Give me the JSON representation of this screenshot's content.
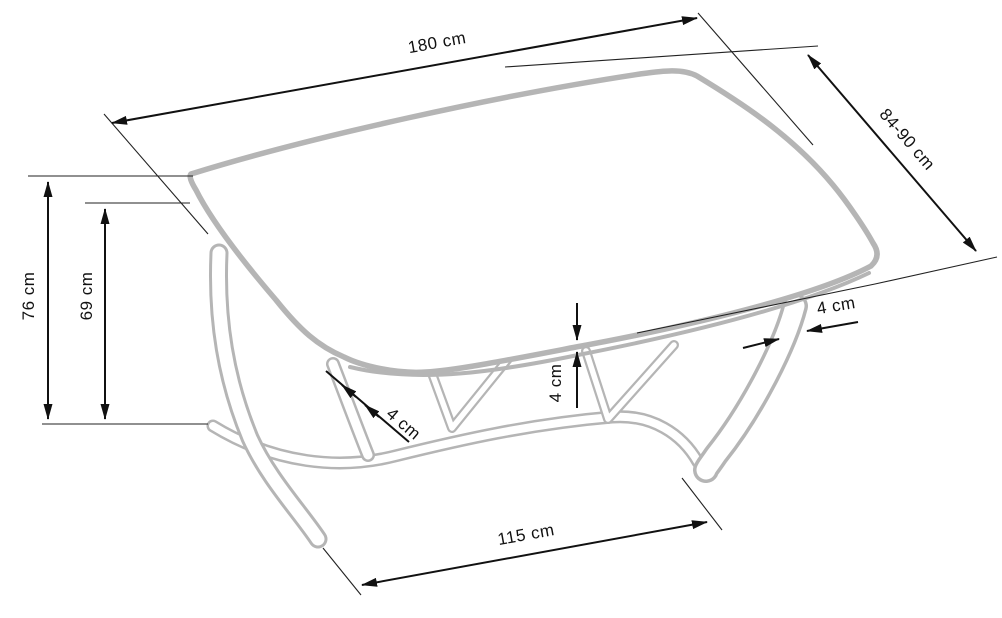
{
  "meta": {
    "drawing_type": "product dimension diagram",
    "object": "dining table"
  },
  "style": {
    "background": "#ffffff",
    "dimension_color": "#111111",
    "furniture_color": "#b5b5b5"
  },
  "dimensions": {
    "table_length": {
      "label": "180 cm",
      "value": "180",
      "unit": "cm"
    },
    "table_depth": {
      "label": "84-90 cm",
      "value": "84-90",
      "unit": "cm"
    },
    "table_height": {
      "label": "76 cm",
      "value": "76",
      "unit": "cm"
    },
    "underside_clearance": {
      "label": "69 cm",
      "value": "69",
      "unit": "cm"
    },
    "top_thickness": {
      "label": "4 cm",
      "value": "4",
      "unit": "cm"
    },
    "left_leg_thickness": {
      "label": "4 cm",
      "value": "4",
      "unit": "cm"
    },
    "right_leg_thickness": {
      "label": "4 cm",
      "value": "4",
      "unit": "cm"
    },
    "base_length": {
      "label": "115 cm",
      "value": "115",
      "unit": "cm"
    }
  }
}
